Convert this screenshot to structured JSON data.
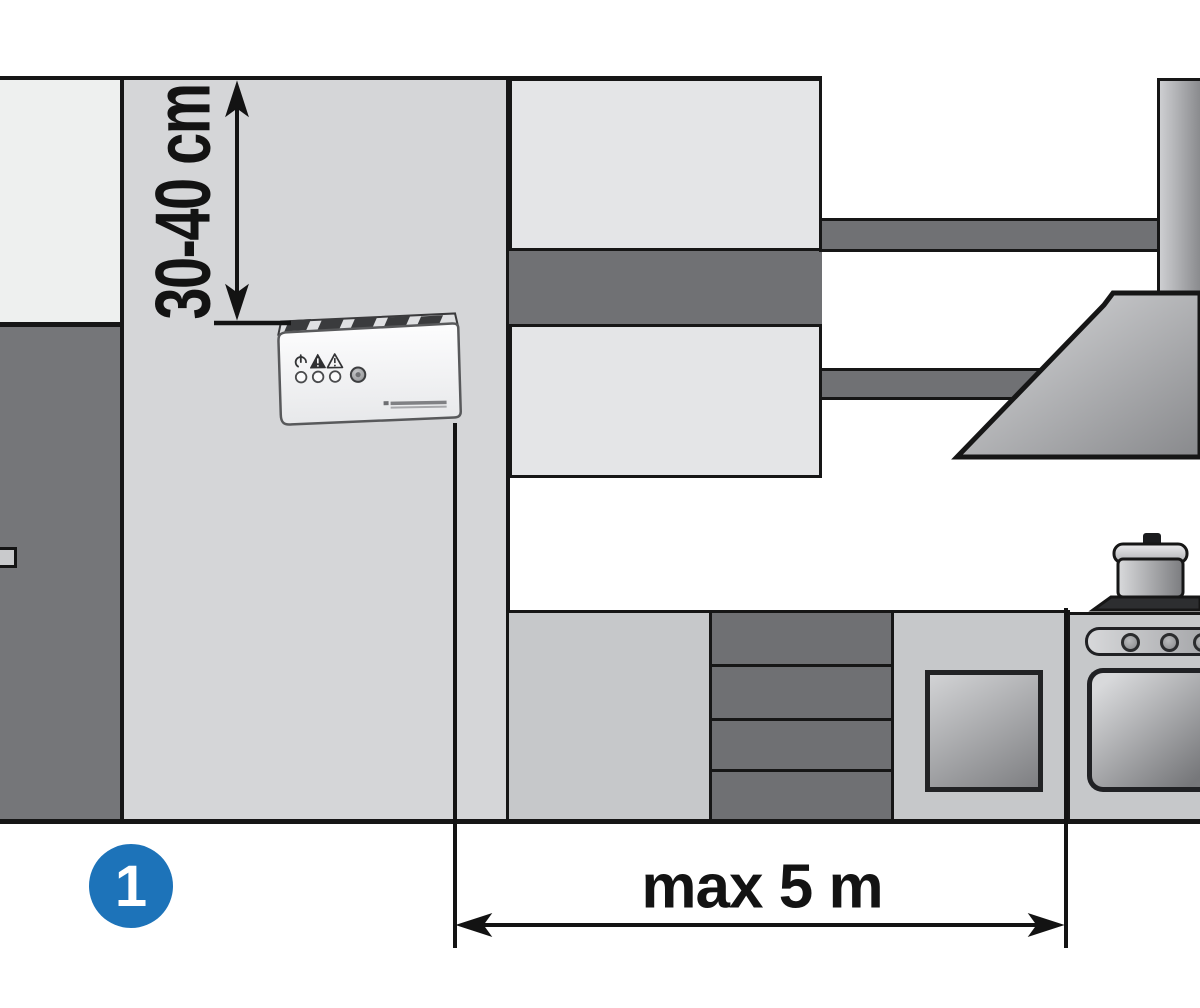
{
  "figure": {
    "type": "installation-diagram",
    "step_badge": "1",
    "dimensions": {
      "vertical_label": "30-40 cm",
      "horizontal_label": "max 5 m"
    }
  },
  "device": {
    "kind": "wall-mounted-gas-alarm",
    "indicator_icons": [
      "power-icon",
      "alarm-warning-triangle-icon",
      "fault-warning-triangle-icon"
    ],
    "led_count": 3,
    "button": "test-button"
  },
  "scene_elements": [
    "left-door",
    "kitchen-wall",
    "upper-cabinet",
    "wall-shelves",
    "range-hood",
    "hood-duct",
    "base-cabinet",
    "drawer-unit",
    "cabinet-door-window",
    "stove-with-pot",
    "oven-door"
  ],
  "colors": {
    "badge_blue": "#1d73b9",
    "wall_gray": "#d5d6d8",
    "cabinet_light": "#e4e5e7",
    "cabinet_base": "#c6c8ca",
    "dark_gray": "#6f7073",
    "line_black": "#161616",
    "background": "#ffffff"
  }
}
